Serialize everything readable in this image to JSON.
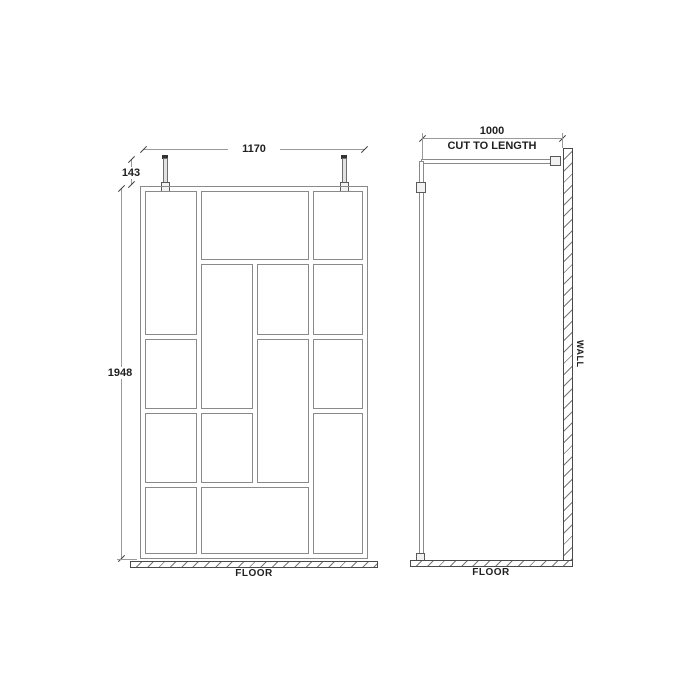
{
  "drawing": {
    "front_view": {
      "width_label": "1170",
      "bracket_height_label": "143",
      "height_label": "1948",
      "floor_label": "FLOOR",
      "panes": [
        [
          145,
          191,
          52,
          144
        ],
        [
          201,
          191,
          108,
          69
        ],
        [
          313,
          191,
          50,
          69
        ],
        [
          201,
          264,
          52,
          145
        ],
        [
          257,
          264,
          52,
          71
        ],
        [
          313,
          264,
          50,
          71
        ],
        [
          145,
          339,
          52,
          70
        ],
        [
          257,
          339,
          52,
          144
        ],
        [
          313,
          339,
          50,
          70
        ],
        [
          145,
          413,
          52,
          70
        ],
        [
          201,
          413,
          52,
          70
        ],
        [
          313,
          413,
          50,
          141
        ],
        [
          145,
          487,
          52,
          67
        ],
        [
          201,
          487,
          108,
          67
        ]
      ]
    },
    "side_view": {
      "depth_label": "1000",
      "depth_note": "CUT TO LENGTH",
      "wall_label": "WALL",
      "floor_label": "FLOOR"
    },
    "colors": {
      "frame_line": "#8a8a8a",
      "dimension_line": "#9a9a9a",
      "tick": "#333333",
      "text": "#1f1f1f",
      "outline": "#4a4a4a",
      "hatch_line": "#777777",
      "background": "#ffffff"
    }
  }
}
